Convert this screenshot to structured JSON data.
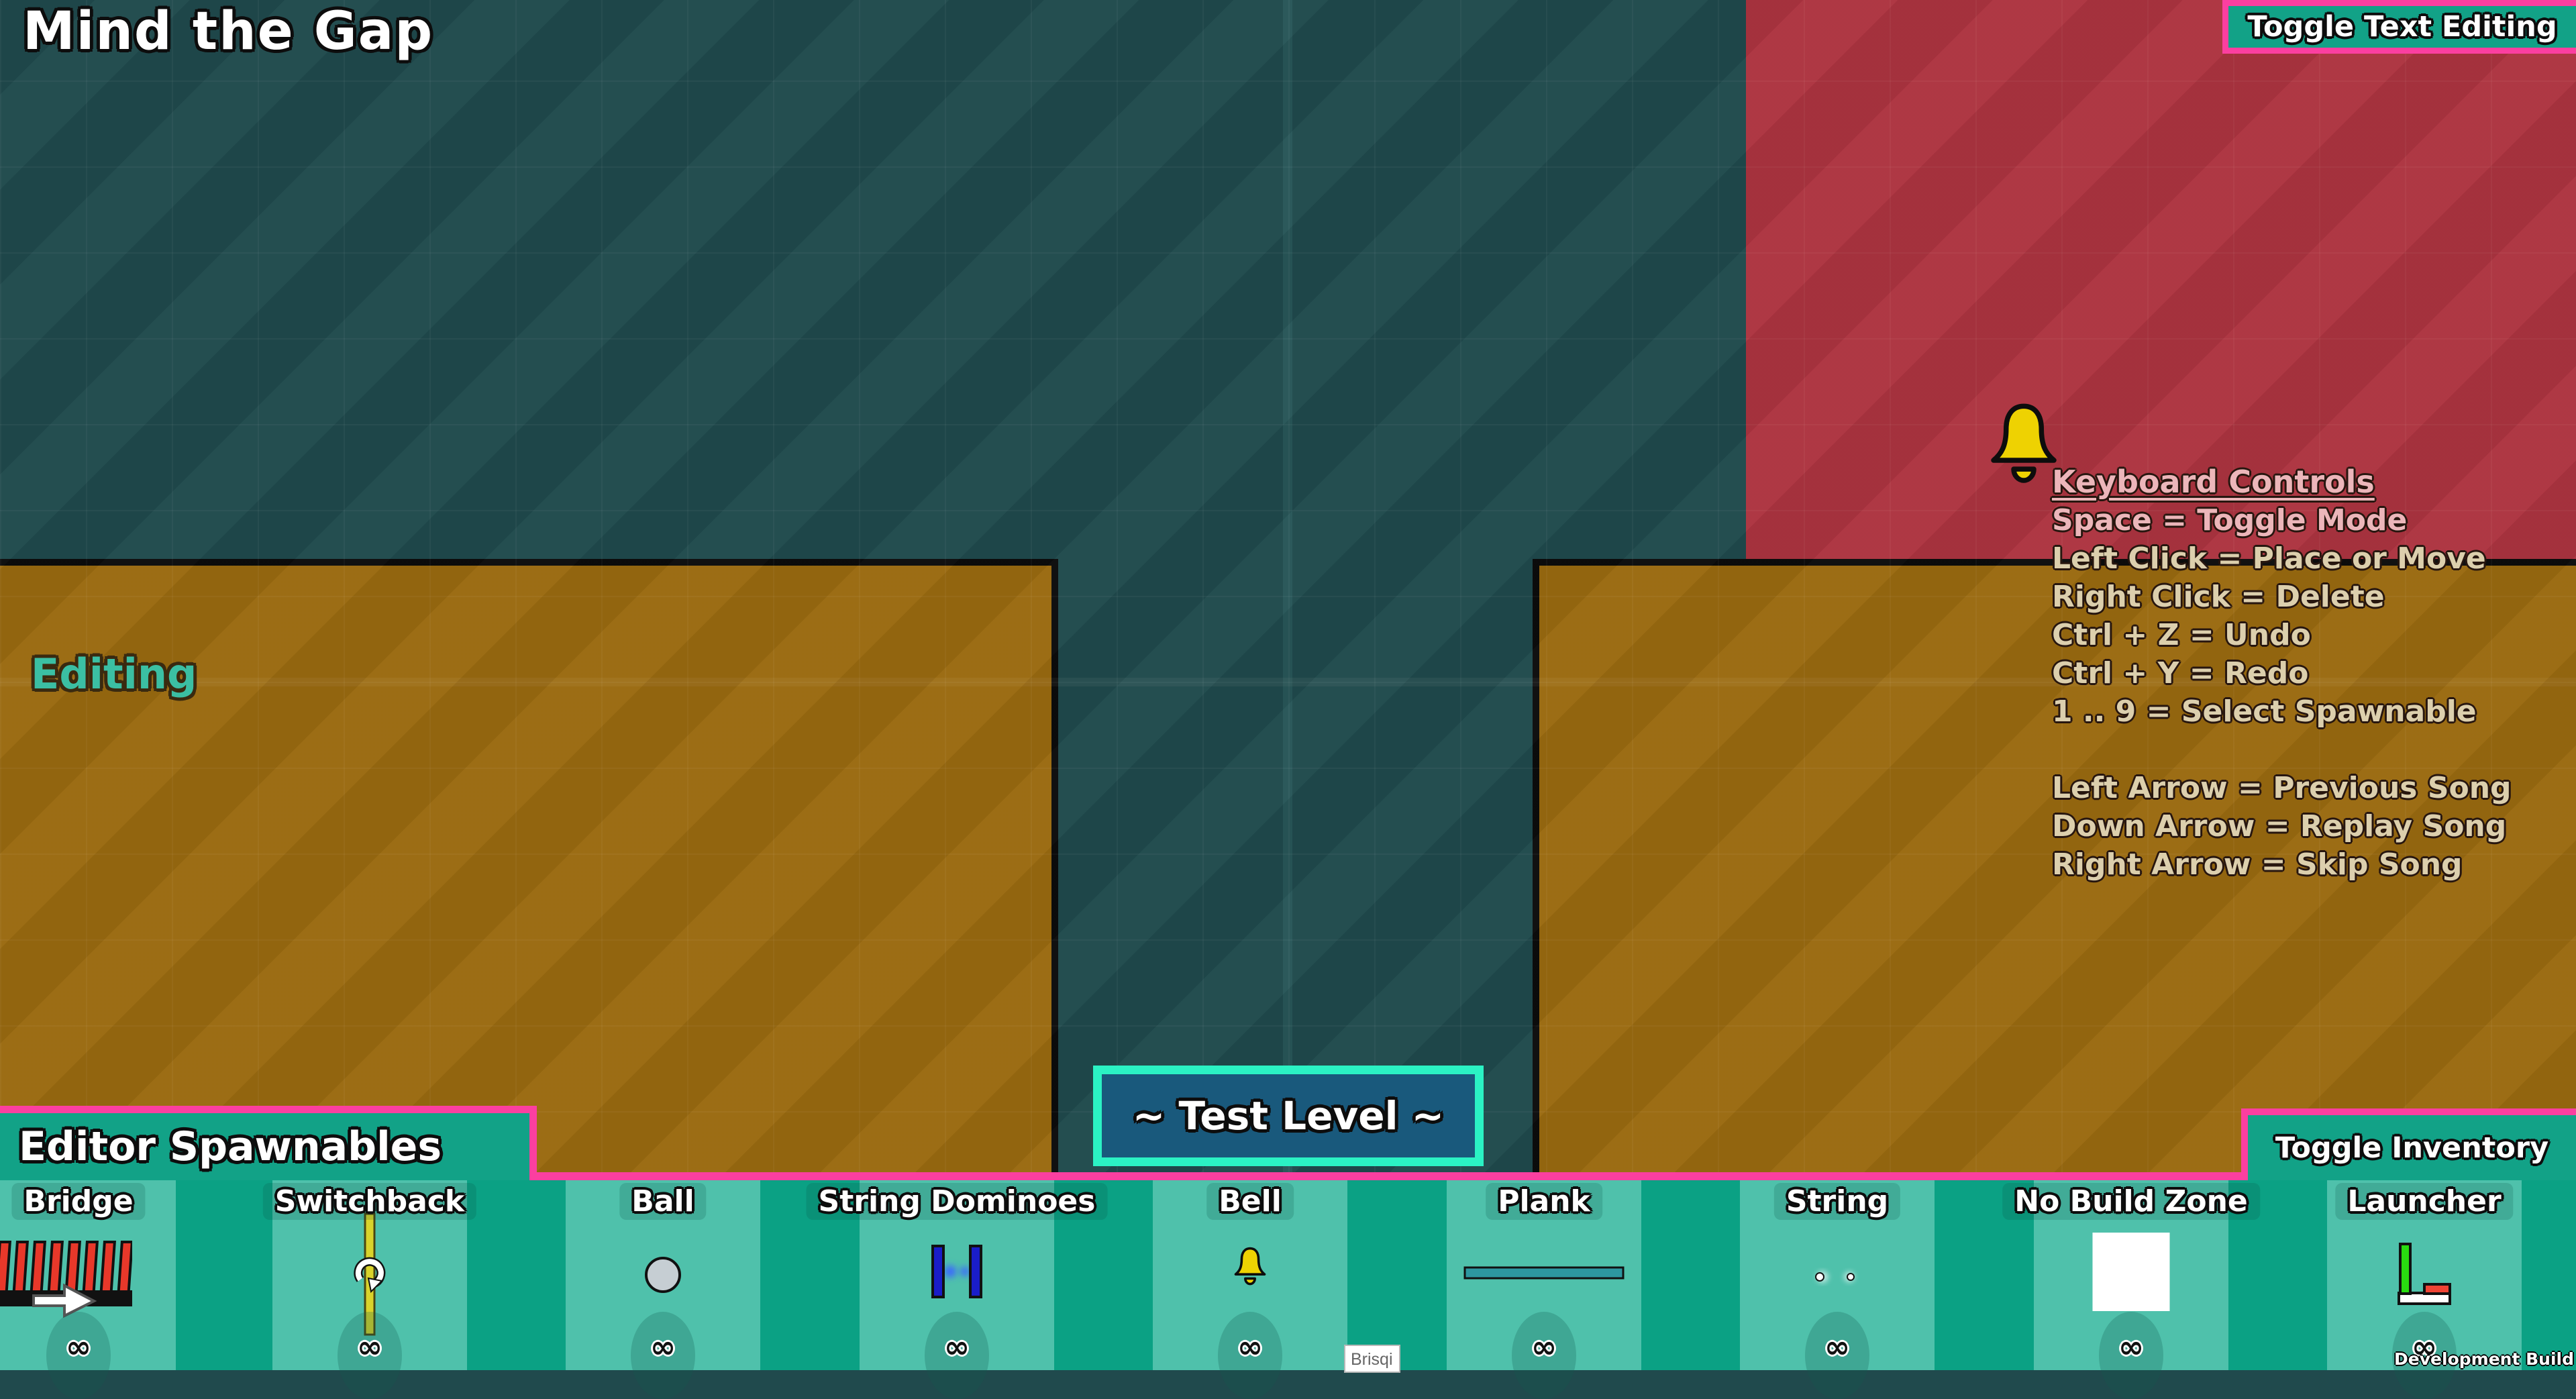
{
  "title": "Mind the Gap",
  "mode_label": "Editing",
  "level_badge": "~ Test Level ~",
  "toggle_text_editing": "Toggle Text Editing",
  "toggle_inventory": "Toggle Inventory",
  "build_label": "Development Build",
  "overlay_window": {
    "title": "Brisqi"
  },
  "keyboard_controls": {
    "heading": "Keyboard Controls",
    "lines": [
      "Space = Toggle Mode",
      "Left Click = Place or Move",
      "Right Click = Delete",
      "Ctrl + Z = Undo",
      "Ctrl + Y = Redo",
      "1 .. 9 = Select Spawnable"
    ],
    "music_lines": [
      "Left Arrow = Previous Song",
      "Down Arrow = Replay Song",
      "Right Arrow = Skip Song"
    ]
  },
  "inventory": {
    "header": "Editor Spawnables",
    "items": [
      {
        "label": "Bridge",
        "count": "∞",
        "icon": "bridge-icon"
      },
      {
        "label": "Switchback",
        "count": "∞",
        "icon": "switchback-icon"
      },
      {
        "label": "Ball",
        "count": "∞",
        "icon": "ball-icon"
      },
      {
        "label": "String Dominoes",
        "count": "∞",
        "icon": "string-dominoes-icon"
      },
      {
        "label": "Bell",
        "count": "∞",
        "icon": "bell-icon"
      },
      {
        "label": "Plank",
        "count": "∞",
        "icon": "plank-icon"
      },
      {
        "label": "String",
        "count": "∞",
        "icon": "string-icon"
      },
      {
        "label": "No Build Zone",
        "count": "∞",
        "icon": "no-build-zone-icon"
      },
      {
        "label": "Launcher",
        "count": "∞",
        "icon": "launcher-icon"
      }
    ]
  },
  "colors": {
    "background_teal": "#204a4d",
    "background_red": "#ad3440",
    "platform_orange": "#9a6a10",
    "panel_green": "#12a287",
    "card_green": "#4fc1ab",
    "accent_pink": "#fb3fa0",
    "badge_border": "#2bf2c4",
    "badge_fill": "#19597c",
    "mode_text_teal": "#3bbfa3",
    "bell_yellow": "#eed202"
  }
}
